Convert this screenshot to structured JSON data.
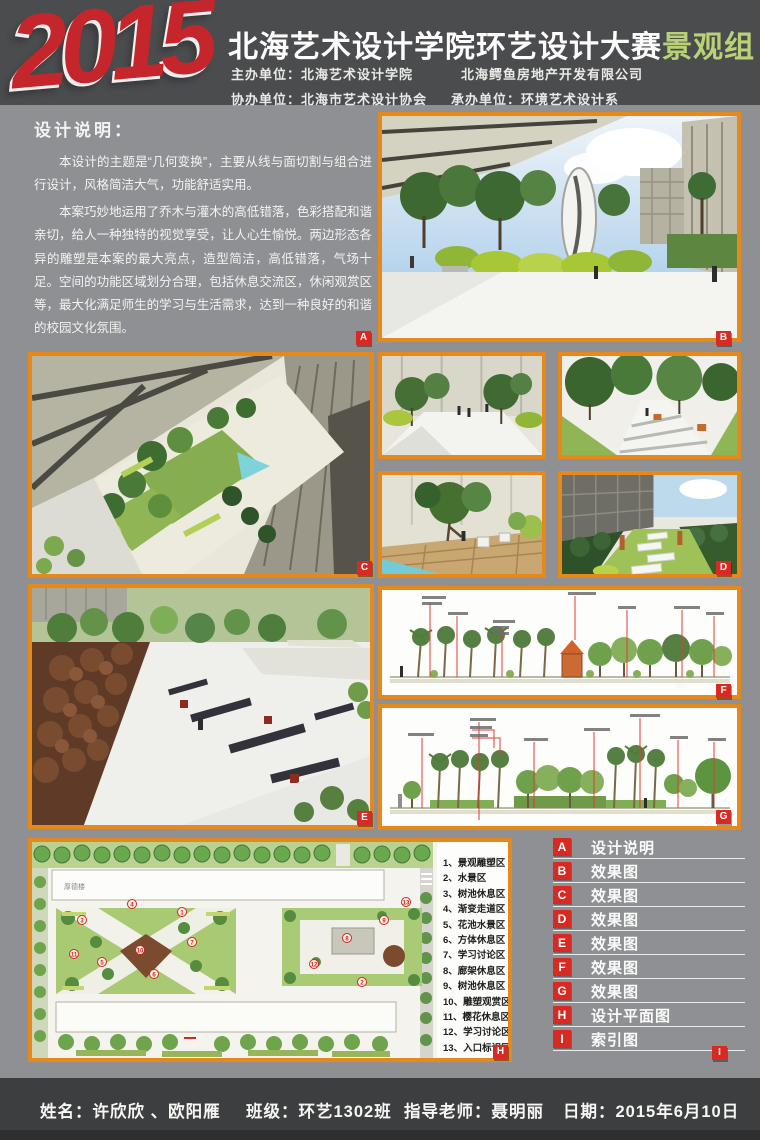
{
  "header": {
    "year": "2015",
    "title": "北海艺术设计学院环艺设计大赛",
    "group": "景观组",
    "host_label": "主办单位：",
    "host": "北海艺术设计学院",
    "host2": "北海鳄鱼房地产开发有限公司",
    "co_label": "协办单位：",
    "co": "北海市艺术设计协会",
    "undertake_label": "承办单位：",
    "undertake": "环境艺术设计系"
  },
  "design_note": {
    "heading": "设计说明：",
    "para1": "本设计的主题是“几何变换”，主要从线与面切割与组合进行设计，风格简洁大气，功能舒适实用。",
    "para2": "本案巧妙地运用了乔木与灌木的高低错落，色彩搭配和谐亲切，给人一种独特的视觉享受，让人心生愉悦。两边形态各异的雕塑是本案的最大亮点，造型简洁，高低错落，气场十足。空间的功能区域划分合理，包括休息交流区，休闲观赏区等，最大化满足师生的学习与生活需求，达到一种良好的和谐的校园文化氛围。"
  },
  "badges": [
    "A",
    "B",
    "C",
    "D",
    "E",
    "F",
    "G",
    "H",
    "I"
  ],
  "plan": {
    "building": "厚德楼",
    "legend": [
      "1、景观雕塑区",
      "2、水景区",
      "3、树池休息区",
      "4、渐变走道区",
      "5、花池水景区",
      "6、方体休息区",
      "7、学习讨论区",
      "8、廊架休息区",
      "9、树池休息区",
      "10、雕塑观赏区",
      "11、樱花休息区",
      "12、学习讨论区",
      "13、入口标识区"
    ],
    "markers": [
      "1",
      "2",
      "3",
      "4",
      "5",
      "6",
      "7",
      "8",
      "9",
      "10",
      "11",
      "12",
      "13"
    ]
  },
  "index": {
    "items": [
      {
        "letter": "A",
        "label": "设计说明"
      },
      {
        "letter": "B",
        "label": "效果图"
      },
      {
        "letter": "C",
        "label": "效果图"
      },
      {
        "letter": "D",
        "label": "效果图"
      },
      {
        "letter": "E",
        "label": "效果图"
      },
      {
        "letter": "F",
        "label": "效果图"
      },
      {
        "letter": "G",
        "label": "效果图"
      },
      {
        "letter": "H",
        "label": "设计平面图"
      },
      {
        "letter": "I",
        "label": "索引图"
      }
    ],
    "corner": "I"
  },
  "footer": {
    "name_label": "姓名：",
    "name": "许欣欣 、欧阳雁",
    "class_label": "班级：",
    "class_value": "环艺1302班",
    "teacher_label": "指导老师：",
    "teacher": "聂明丽",
    "date_label": "日期：",
    "date": "2015年6月10日"
  },
  "colors": {
    "accent_orange": "#e6891d",
    "badge_red": "#d62a22",
    "title_green": "#b8d276",
    "year_red": "#c5262c"
  }
}
